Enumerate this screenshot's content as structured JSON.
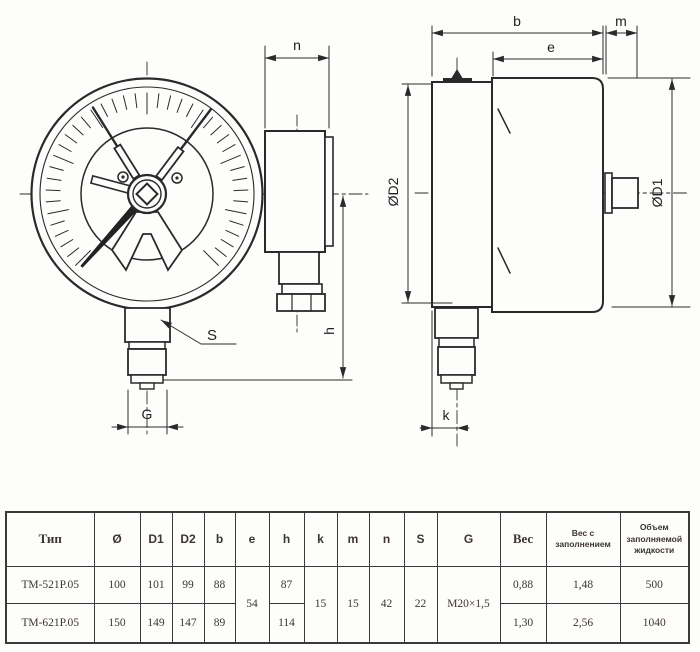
{
  "drawing": {
    "labels": {
      "n": "n",
      "b": "b",
      "e": "e",
      "m": "m",
      "d2": "ØD2",
      "d1": "ØD1",
      "h": "h",
      "s": "S",
      "g": "G",
      "k": "k"
    }
  },
  "table": {
    "headers": [
      "Тип",
      "Ø",
      "D1",
      "D2",
      "b",
      "e",
      "h",
      "k",
      "m",
      "n",
      "S",
      "G",
      "Вес",
      "Вес с заполнением",
      "Объем заполняемой жидкости"
    ],
    "rows": [
      {
        "type": "ТМ-521Р.05",
        "dia": "100",
        "d1": "101",
        "d2": "99",
        "b": "88",
        "h": "87",
        "weight": "0,88",
        "weight_filled": "1,48",
        "volume": "500"
      },
      {
        "type": "ТМ-621Р.05",
        "dia": "150",
        "d1": "149",
        "d2": "147",
        "b": "89",
        "h": "114",
        "weight": "1,30",
        "weight_filled": "2,56",
        "volume": "1040"
      }
    ],
    "shared": {
      "e": "54",
      "k": "15",
      "m": "15",
      "n": "42",
      "s": "22",
      "g": "М20×1,5"
    }
  }
}
